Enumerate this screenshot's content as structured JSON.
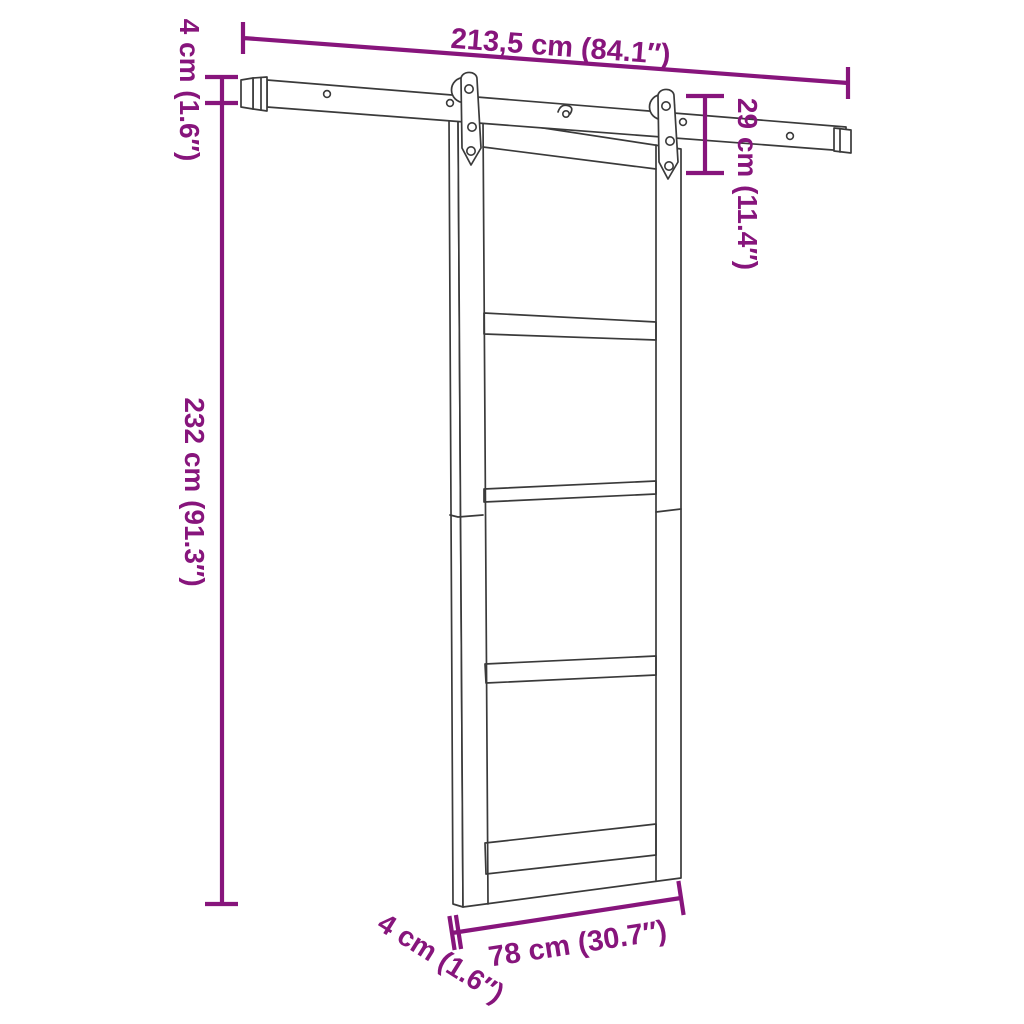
{
  "diagram": {
    "type": "product-dimension-diagram",
    "colors": {
      "background": "#ffffff",
      "drawing": "#3a3a3a",
      "dimension": "#87157c"
    },
    "labels": {
      "rail_length": "213,5 cm (84.1″)",
      "rail_height": "4 cm (1.6″)",
      "drop_height": "29 cm (11.4″)",
      "door_height": "232 cm (91.3″)",
      "door_width": "78 cm (30.7″)",
      "door_thickness": "4 cm (1.6″)"
    }
  }
}
